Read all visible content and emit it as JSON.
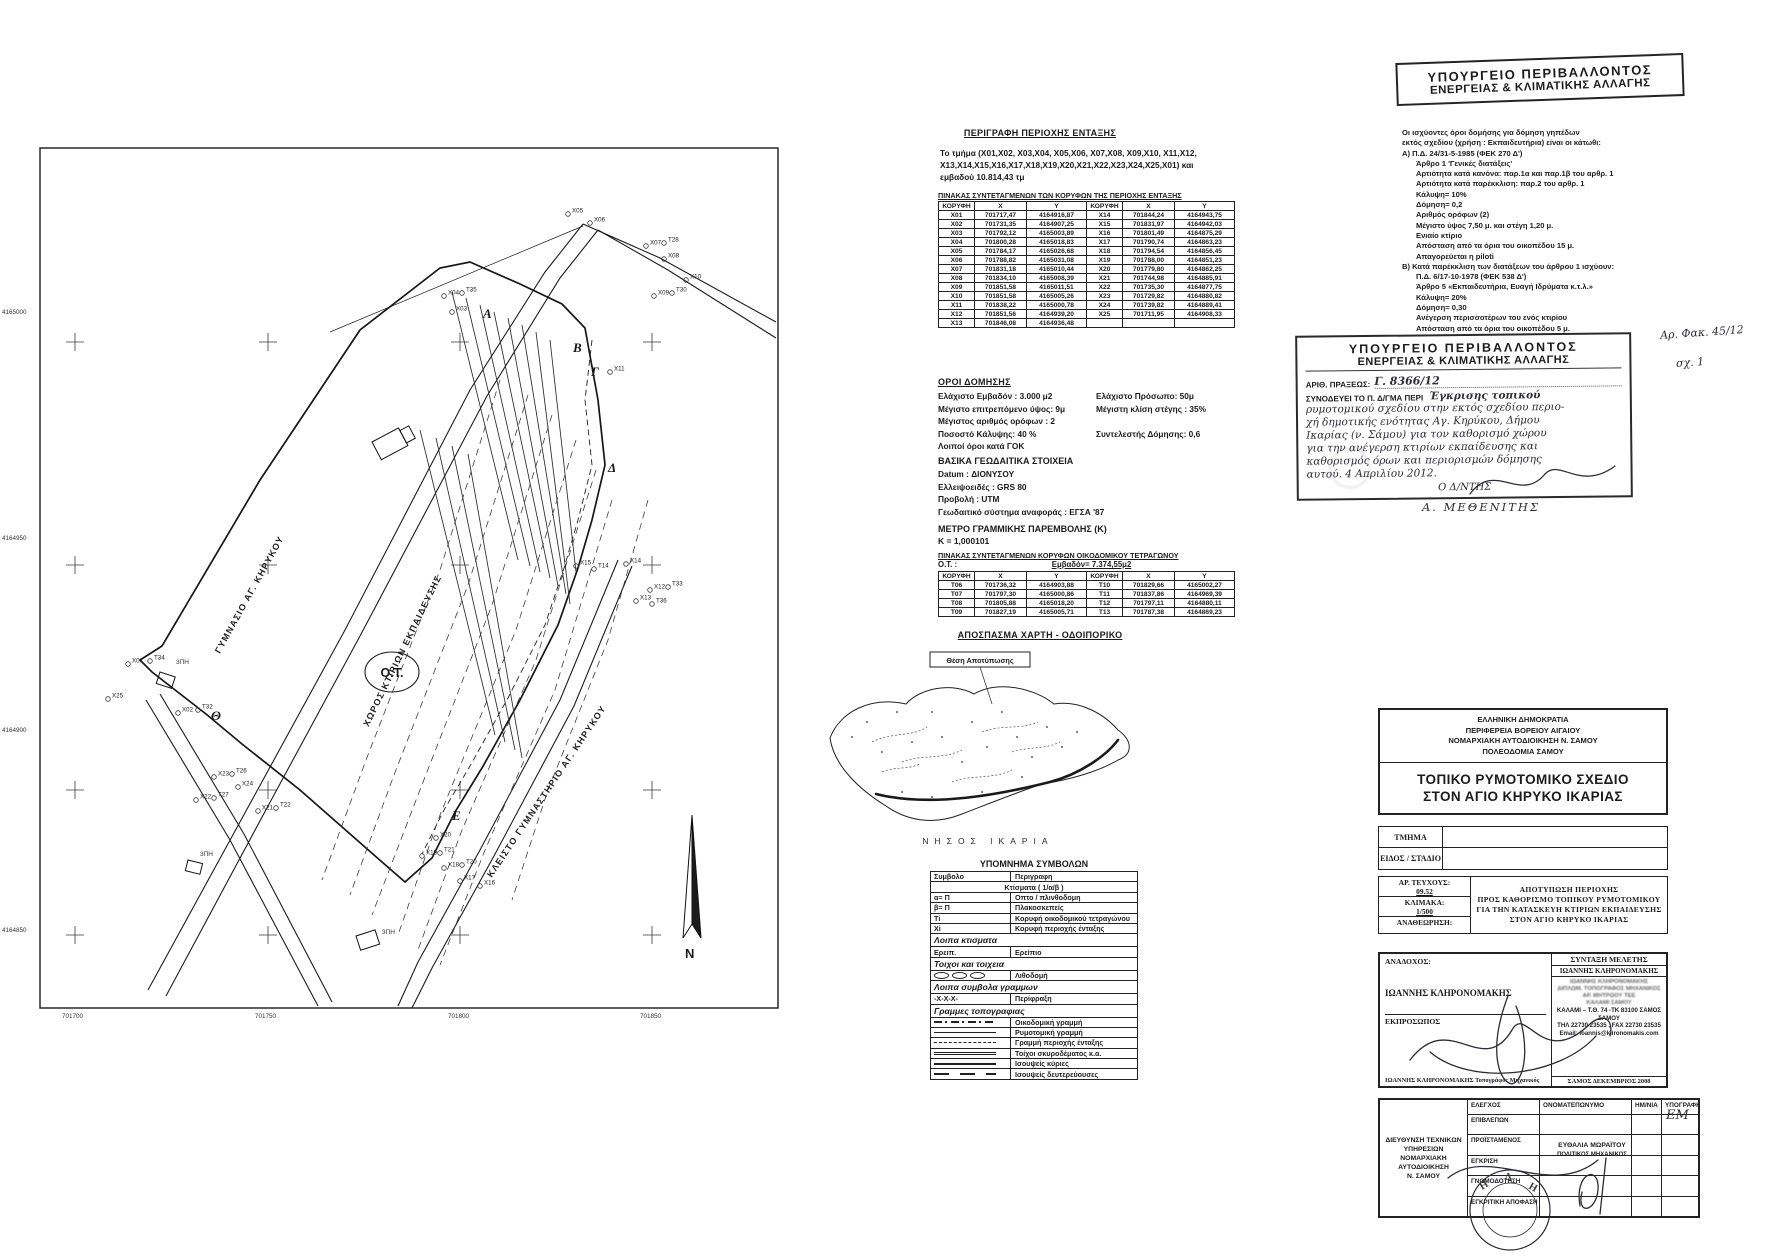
{
  "map": {
    "ot_label": "Ο.Τ.",
    "north_label": "Ν",
    "axis_left": [
      {
        "label": "4165000",
        "x": 2,
        "y": 314
      },
      {
        "label": "4164950",
        "x": 2,
        "y": 540
      },
      {
        "label": "4164900",
        "x": 2,
        "y": 732
      },
      {
        "label": "4164850",
        "x": 2,
        "y": 932
      }
    ],
    "axis_bottom": [
      {
        "label": "701700",
        "x": 62,
        "y": 1018
      },
      {
        "label": "701750",
        "x": 255,
        "y": 1018
      },
      {
        "label": "701800",
        "x": 448,
        "y": 1018
      },
      {
        "label": "701850",
        "x": 640,
        "y": 1018
      }
    ],
    "crosses": [
      {
        "x": 75,
        "y": 342
      },
      {
        "x": 268,
        "y": 342
      },
      {
        "x": 460,
        "y": 342
      },
      {
        "x": 652,
        "y": 342
      },
      {
        "x": 75,
        "y": 565
      },
      {
        "x": 268,
        "y": 565
      },
      {
        "x": 460,
        "y": 565
      },
      {
        "x": 652,
        "y": 565
      },
      {
        "x": 75,
        "y": 790
      },
      {
        "x": 268,
        "y": 790
      },
      {
        "x": 460,
        "y": 790
      },
      {
        "x": 652,
        "y": 790
      },
      {
        "x": 75,
        "y": 935
      },
      {
        "x": 268,
        "y": 935
      },
      {
        "x": 460,
        "y": 935
      },
      {
        "x": 652,
        "y": 935
      }
    ],
    "letters": [
      {
        "label": "Α",
        "x": 483,
        "y": 318
      },
      {
        "label": "Β",
        "x": 573,
        "y": 352
      },
      {
        "label": "Γ",
        "x": 591,
        "y": 376
      },
      {
        "label": "Δ",
        "x": 608,
        "y": 472
      },
      {
        "label": "Ε",
        "x": 452,
        "y": 820
      },
      {
        "label": "Θ",
        "x": 211,
        "y": 720
      }
    ],
    "points": [
      {
        "label": "X01",
        "x": 128,
        "y": 664
      },
      {
        "label": "T34",
        "x": 150,
        "y": 661
      },
      {
        "label": "X25",
        "x": 108,
        "y": 699
      },
      {
        "label": "X02",
        "x": 178,
        "y": 713
      },
      {
        "label": "T32",
        "x": 198,
        "y": 710
      },
      {
        "label": "X23",
        "x": 214,
        "y": 777
      },
      {
        "label": "T26",
        "x": 232,
        "y": 774
      },
      {
        "label": "X22",
        "x": 196,
        "y": 800
      },
      {
        "label": "T27",
        "x": 214,
        "y": 798
      },
      {
        "label": "X24",
        "x": 238,
        "y": 787
      },
      {
        "label": "X21",
        "x": 258,
        "y": 811
      },
      {
        "label": "T22",
        "x": 276,
        "y": 808
      },
      {
        "label": "X03",
        "x": 452,
        "y": 312
      },
      {
        "label": "X04",
        "x": 444,
        "y": 296
      },
      {
        "label": "T35",
        "x": 462,
        "y": 293
      },
      {
        "label": "X05",
        "x": 568,
        "y": 214
      },
      {
        "label": "X06",
        "x": 590,
        "y": 223
      },
      {
        "label": "X07",
        "x": 646,
        "y": 246
      },
      {
        "label": "T28",
        "x": 664,
        "y": 243
      },
      {
        "label": "X08",
        "x": 664,
        "y": 259
      },
      {
        "label": "X09",
        "x": 654,
        "y": 296
      },
      {
        "label": "T30",
        "x": 672,
        "y": 293
      },
      {
        "label": "X10",
        "x": 686,
        "y": 280
      },
      {
        "label": "X11",
        "x": 610,
        "y": 372
      },
      {
        "label": "X12",
        "x": 650,
        "y": 590
      },
      {
        "label": "T33",
        "x": 668,
        "y": 587
      },
      {
        "label": "X13",
        "x": 636,
        "y": 601
      },
      {
        "label": "T36",
        "x": 652,
        "y": 604
      },
      {
        "label": "X14",
        "x": 626,
        "y": 564
      },
      {
        "label": "X15",
        "x": 576,
        "y": 566
      },
      {
        "label": "T14",
        "x": 594,
        "y": 569
      },
      {
        "label": "X20",
        "x": 436,
        "y": 838
      },
      {
        "label": "X19",
        "x": 422,
        "y": 856
      },
      {
        "label": "T21",
        "x": 440,
        "y": 853
      },
      {
        "label": "X18",
        "x": 444,
        "y": 868
      },
      {
        "label": "T20",
        "x": 462,
        "y": 865
      },
      {
        "label": "X17",
        "x": 460,
        "y": 881
      },
      {
        "label": "X16",
        "x": 480,
        "y": 886
      }
    ],
    "small_labels": [
      {
        "label": "3ΠΗ",
        "x": 176,
        "y": 664
      },
      {
        "label": "3ΠΗ",
        "x": 200,
        "y": 856
      },
      {
        "label": "3ΠΗ",
        "x": 382,
        "y": 934
      }
    ],
    "road_labels": [
      {
        "label": "ΓΥΜΝΑΣΙΟ ΑΓ. ΚΗΡΥΚΟΥ",
        "x": 252,
        "y": 596,
        "r": -61
      },
      {
        "label": "ΚΛΕΙΣΤΟ ΓΥΜΝΑΣΤΗΡΙΟ ΑΓ. ΚΗΡΥΚΟΥ",
        "x": 549,
        "y": 793,
        "r": -56
      },
      {
        "label": "ΧΩΡΟΣ ΚΤΙΡΙΩΝ ΕΚΠΑΙΔΕΥΣΗΣ",
        "x": 405,
        "y": 652,
        "r": -64
      }
    ]
  },
  "mid": {
    "perigrafi_title": "ΠΕΡΙΓΡΑΦΗ ΠΕΡΙΟΧΗΣ ΕΝΤΑΞΗΣ",
    "perigrafi_text": "Το τμήμα (Χ01,Χ02, Χ03,Χ04, Χ05,Χ06, Χ07,Χ08, Χ09,Χ10, Χ11,Χ12, Χ13,Χ14,Χ15,Χ16,Χ17,Χ18,Χ19,Χ20,Χ21,Χ22,Χ23,Χ24,Χ25,Χ01) και εμβαδού 10.814,43 τμ",
    "coords_table": {
      "title": "ΠΙΝΑΚΑΣ  ΣΥΝΤΕΤΑΓΜΕΝΩΝ ΤΩΝ  ΚΟΡΥΦΩΝ ΤΗΣ ΠΕΡΙΟΧΗΣ ΕΝΤΑΞΗΣ",
      "headers": [
        "ΚΟΡΥΦΗ",
        "Χ",
        "Υ",
        "ΚΟΡΥΦΗ",
        "Χ",
        "Υ"
      ],
      "rows": [
        [
          "X01",
          "701717,47",
          "4164916,87",
          "X14",
          "701844,24",
          "4164943,75"
        ],
        [
          "X02",
          "701731,35",
          "4164907,25",
          "X15",
          "701831,97",
          "4164942,03"
        ],
        [
          "X03",
          "701792,12",
          "4165003,89",
          "X16",
          "701801,49",
          "4164875,29"
        ],
        [
          "X04",
          "701800,28",
          "4165018,83",
          "X17",
          "701790,74",
          "4164863,23"
        ],
        [
          "X05",
          "701784,17",
          "4165026,68",
          "X18",
          "701794,54",
          "4164856,45"
        ],
        [
          "X06",
          "701788,82",
          "4165031,08",
          "X19",
          "701788,00",
          "4164851,23"
        ],
        [
          "X07",
          "701831,18",
          "4165010,44",
          "X20",
          "701779,80",
          "4164862,25"
        ],
        [
          "X08",
          "701834,10",
          "4165008,39",
          "X21",
          "701744,98",
          "4164885,91"
        ],
        [
          "X09",
          "701851,58",
          "4165011,51",
          "X22",
          "701735,30",
          "4164877,75"
        ],
        [
          "X10",
          "701851,58",
          "4165005,26",
          "X23",
          "701729,82",
          "4164880,82"
        ],
        [
          "X11",
          "701838,22",
          "4165000,78",
          "X24",
          "701739,82",
          "4164889,41"
        ],
        [
          "X12",
          "701851,56",
          "4164939,20",
          "X25",
          "701711,95",
          "4164908,33"
        ],
        [
          "X13",
          "701846,08",
          "4164936,48",
          "",
          "",
          ""
        ]
      ]
    },
    "oroi": {
      "title": "ΟΡΟΙ ΔΟΜΗΣΗΣ",
      "rows": [
        {
          "l": "Ελάχιστο Εμβαδόν : 3.000 μ2",
          "r": "Ελάχιστο Πρόσωπο: 50μ"
        },
        {
          "l": "Μέγιστο επιτρεπόμενο ύψος:  9μ",
          "r": "Μέγιστη κλίση στέγης :  35%"
        },
        {
          "l": "Μέγιστος αριθμός ορόφων : 2",
          "r": ""
        },
        {
          "l": "Ποσοστό Κάλυψης: 40 %",
          "r": "Συντελεστής Δόμησης: 0,6"
        },
        {
          "l": "Λοιποί όροι κατά ΓΟΚ",
          "r": ""
        }
      ]
    },
    "geo": {
      "title": "ΒΑΣΙΚΑ ΓΕΩΔΑΙΤΙΚΑ ΣΤΟΙΧΕΙΑ",
      "lines": [
        "Datum : ΔΙΟΝΥΣΟΥ",
        "Ελλειψοειδές : GRS 80",
        "Προβολή : UTM",
        "Γεωδαιτικό σύστημα αναφοράς : ΕΓΣΑ '87"
      ]
    },
    "metro": {
      "title": "ΜΕΤΡΟ ΓΡΑΜΜΙΚΗΣ ΠΑΡΕΜΒΟΛΗΣ (Κ)",
      "value": "Κ = 1,000101"
    },
    "ot_table": {
      "title": "ΠΙΝΑΚΑΣ  ΣΥΝΤΕΤΑΓΜΕΝΩΝ  ΚΟΡΥΦΩΝ ΟΙΚΟΔΟΜΙΚΟΥ ΤΕΤΡΑΓΩΝΟΥ",
      "ot_label": "Ο.Τ. :",
      "area_label": "Εμβαδόν= 7.374,55μ2",
      "headers": [
        "ΚΟΡΥΦΗ",
        "Χ",
        "Υ",
        "ΚΟΡΥΦΗ",
        "Χ",
        "Υ"
      ],
      "rows": [
        [
          "T06",
          "701736,32",
          "4164903,88",
          "T10",
          "701829,66",
          "4165002,27"
        ],
        [
          "T07",
          "701797,30",
          "4165000,86",
          "T11",
          "701837,86",
          "4164969,39"
        ],
        [
          "T08",
          "701805,88",
          "4165018,20",
          "T12",
          "701797,11",
          "4164880,11"
        ],
        [
          "T09",
          "701827,19",
          "4165005,71",
          "T13",
          "701787,38",
          "4164869,23"
        ]
      ]
    },
    "apospasma_title": "ΑΠΟΣΠΑΣΜΑ ΧΑΡΤΗ - ΟΔΟΙΠΟΡΙΚΟ",
    "island": {
      "box_label": "Θέση Αποτύπωσης",
      "caption": "ΝΗΣΟΣ  ΙΚΑΡΙΑ"
    },
    "legend": {
      "title": "ΥΠΟΜΝΗΜΑ ΣΥΜΒΟΛΩΝ",
      "rows": [
        {
          "kind": "header",
          "sym": "Συμβολο",
          "desc": "Περιγραφη"
        },
        {
          "kind": "span",
          "sym": "",
          "desc": "Κτίσματα    ( 1/α/β )"
        },
        {
          "sym": "α= Π",
          "desc": "Οπτο / πλινθοδομη"
        },
        {
          "sym": "β= Π",
          "desc": "Πλακοσκεπείς"
        },
        {
          "sym": "Τi",
          "desc": "Κορυφή οικοδομικού τετραγώνου"
        },
        {
          "sym": "Xi",
          "desc": "Κορυφή περιοχής ένταξης"
        },
        {
          "kind": "section",
          "sym": "Λοιπα κτισματα",
          "desc": ""
        },
        {
          "sym": "Ερειπ.",
          "desc": "Ερείπιο"
        },
        {
          "kind": "section",
          "sym": "Τοιχοι και τοιχεια",
          "desc": ""
        },
        {
          "cls": "ovals",
          "sym": "",
          "desc": "Λιθοδομή"
        },
        {
          "kind": "section",
          "sym": "Λοιπα συμβολα γραμμων",
          "desc": ""
        },
        {
          "sym": "-Χ-Χ-Χ-",
          "desc": "Περίφραξη"
        },
        {
          "kind": "section",
          "sym": "Γραμμες τοπογραφιας",
          "des c": ""
        },
        {
          "cls": "dashdot",
          "sym": "",
          "desc": "Οικοδομική γραμμή"
        },
        {
          "cls": "solid",
          "sym": "",
          "desc": "Ρυμοτομική γραμμή"
        },
        {
          "cls": "dashed",
          "sym": "",
          "desc": "Γραμμή περιοχής ένταξης"
        },
        {
          "cls": "double",
          "sym": "",
          "desc": "Τοίχοι  σκυροδέματος κ.α."
        },
        {
          "cls": "thick",
          "sym": "",
          "desc": "Ισουψείς κύριες"
        },
        {
          "cls": "longdash",
          "sym": "",
          "desc": "Ισουψείς δευτερεύουσες"
        }
      ]
    }
  },
  "right": {
    "ministry_stamp": {
      "line1": "ΥΠΟΥΡΓΕΙΟ  ΠΕΡΙΒΑΛΛΟΝΤΟΣ",
      "line2": "ΕΝΕΡΓΕΙΑΣ  &  ΚΛΙΜΑΤΙΚΗΣ  ΑΛΛΑΓΗΣ"
    },
    "terms": {
      "lines": [
        {
          "t": "Οι ισχύοντες όροι δομήσης για δόμηση γηπέδων",
          "cls": ""
        },
        {
          "t": "εκτός σχεδίου (χρήση : Εκπαιδευτήρια) είναι οι κάτωθι:",
          "cls": ""
        },
        {
          "t": "Α)  Π.Δ. 24/31-5-1985 (ΦΕΚ 270 Δ')",
          "cls": ""
        },
        {
          "t": "Άρθρο 1   'Γενικές διατάξεις'",
          "cls": "i1"
        },
        {
          "t": "Αρτιότητα κατά κανόνα: παρ.1α και παρ.1β του αρθρ. 1",
          "cls": "i1"
        },
        {
          "t": "Αρτιότητα κατά παρέκκλιση: παρ.2 του αρθρ. 1",
          "cls": "i1"
        },
        {
          "t": "Κάλυψη= 10%",
          "cls": "i1"
        },
        {
          "t": "Δόμηση= 0,2",
          "cls": "i1"
        },
        {
          "t": "Αριθμός ορόφων (2)",
          "cls": "i1"
        },
        {
          "t": "Μέγιστο ύψος 7,50 μ. και στέγη 1,20 μ.",
          "cls": "i1"
        },
        {
          "t": "Ενιαίο κτίριο",
          "cls": "i1"
        },
        {
          "t": "Απόσταση από τα όρια του οικοπέδου 15 μ.",
          "cls": "i1"
        },
        {
          "t": "Απαγορεύεται η piloti",
          "cls": "i1"
        },
        {
          "t": "Β) Κατά παρέκκλιση των διατάξεων του άρθρου 1 ισχύουν:",
          "cls": ""
        },
        {
          "t": "Π.Δ. 6/17-10-1978 (ΦΕΚ 538 Δ')",
          "cls": "i1"
        },
        {
          "t": "Άρθρο 5   «Εκπαιδευτήρια, Ευαγή Ιδρύματα κ.τ.λ.»",
          "cls": "i1"
        },
        {
          "t": "Κάλυψη= 20%",
          "cls": "i1"
        },
        {
          "t": "Δόμηση= 0,30",
          "cls": "i1"
        },
        {
          "t": "Ανέγερση περισσοτέρων του ενός κτιρίου",
          "cls": "i1"
        },
        {
          "t": "Απόσταση από τα όρια του οικοπέδου 5 μ.",
          "cls": "i1"
        }
      ]
    },
    "approval": {
      "line1": "ΥΠΟΥΡΓΕΙΟ  ΠΕΡΙΒΑΛΛΟΝΤΟΣ",
      "line2": "ΕΝΕΡΓΕΙΑΣ  &  ΚΛΙΜΑΤΙΚΗΣ  ΑΛΛΑΓΗΣ",
      "praxis_label": "ΑΡΙΘ. ΠΡΑΞΕΩΣ:",
      "praxis_value": "Γ. 8366/12",
      "accompany_label": "ΣΥΝΟΔΕΥΕΙ ΤΟ Π. Δ/ΓΜΑ ΠΕΡΙ",
      "first_hand": "Έγκρισης τοπικού",
      "hand_lines": [
        "ρυμοτομικού σχεδίου στην εκτός σχεδίου περιο-",
        "χή δημοτικής ενότητας Αγ. Κηρύκου, Δήμου",
        "Ικαρίας (ν. Σάμου) για τον καθορισμό χώρου",
        "για την ανέγερση κτιρίων εκπαίδευσης και",
        "καθορισμός όρων και περιορισμών δόμησης",
        "αυτού.        4 Απριλίου 2012."
      ],
      "director": "Ο  Δ/ΝΤΗΣ",
      "signer": "Α. ΜΕΘΕΝΙΤΗΣ",
      "folder_note": "Αρ. Φακ. 45/12",
      "sheet_note": "σχ. 1"
    },
    "title_block": {
      "org_lines": [
        "ΕΛΛΗΝΙΚΗ ΔΗΜΟΚΡΑΤΙΑ",
        "ΠΕΡΙΦΕΡΕΙΑ ΒΟΡΕΙΟΥ ΑΙΓΑΙΟΥ",
        "ΝΟΜΑΡΧΙΑΚΗ ΑΥΤΟΔΙΟΙΚΗΣΗ  Ν. ΣΑΜΟΥ",
        "ΠΟΛΕΟΔΟΜΙΑ ΣΑΜΟΥ"
      ],
      "title_lines": [
        "ΤΟΠΙΚΟ ΡΥΜΟΤΟΜΙΚΟ ΣΧΕΔΙΟ",
        "ΣΤΟΝ ΑΓΙΟ ΚΗΡΥΚΟ ΙΚΑΡΙΑΣ"
      ],
      "tmima_label": "ΤΜΗΜΑ",
      "eidos_label": "ΕΙΔΟΣ / ΣΤΑΔΙΟ",
      "ar_tefxous_label": "ΑΡ. ΤΕΥΧΟΥΣ:",
      "ar_tefxous_value": "09.52",
      "klimaka_label": "ΚΛΙΜΑΚΑ:",
      "klimaka_value": "1/500",
      "anatheorisi_label": "ΑΝΑΘΕΩΡΗΣΗ:",
      "subject_lines": [
        "ΑΠΟΤΥΠΩΣΗ ΠΕΡΙΟΧΗΣ",
        "ΠΡΟΣ ΚΑΘΟΡΙΣΜΟ ΤΟΠΙΚΟΥ ΡΥΜΟΤΟΜΙΚΟΥ",
        "ΓΙΑ ΤΗΝ ΚΑΤΑΣΚΕΥΗ ΚΤΙΡΙΩΝ ΕΚΠΑΙΔΕΥΣΗΣ",
        "ΣΤΟΝ ΑΓΙΟ ΚΗΡΥΚΟ ΙΚΑΡΙΑΣ"
      ]
    },
    "contractor": {
      "anadoxos_label": "ΑΝΑΔΟΧΟΣ:",
      "anadoxos_name": "ΙΩΑΝΝΗΣ ΚΛΗΡΟΝΟΜΑΚΗΣ",
      "ekprosopos_label": "ΕΚΠΡΟΣΩΠΟΣ",
      "anadoxos_footer": "ΙΩΑΝΝΗΣ ΚΛΗΡΟΝΟΜΑΚΗΣ  Τοπογράφος Μηχανικός",
      "syntaxi_label": "ΣΥΝΤΑΞΗ ΜΕΛΕΤΗΣ",
      "syntaxi_name": "ΙΩΑΝΝΗΣ ΚΛΗΡΟΝΟΜΑΚΗΣ",
      "stamp_lines": [
        "ΙΩΑΝΝΗΣ ΚΛΗΡΟΝΟΜΑΚΗΣ",
        "ΔΙΠΛΩΜ. ΤΟΠΟΓΡΑΦΟΣ ΜΗΧΑΝΙΚΟΣ",
        "ΑΡ. ΜΗΤΡΩΟΥ ΤΕΕ",
        "ΚΑΛΑΜΙ ΣΑΜΟΥ"
      ],
      "address_lines": [
        "ΚΑΛΑΜΙ – Τ.Θ. 74 -ΤΚ 83100 ΣΑΜΟΣ",
        "ΣΑΜΟΥ",
        "ΤΗΛ 22730 23535 , FAX 22730 23535",
        "Email: ioannis@klironomakis.com"
      ],
      "date_line": "ΣΑΜΟΣ ΔΕΚΕΜΒΡΙΟΣ 2008"
    },
    "control": {
      "left_header_lines": [
        "ΔΙΕΥΘΥΝΣΗ ΤΕΧΝΙΚΩΝ",
        "ΥΠΗΡΕΣΙΩΝ",
        "ΝΟΜΑΡΧΙΑΚΗ",
        "ΑΥΤΟΔΙΟΙΚΗΣΗ",
        "Ν. ΣΑΜΟΥ"
      ],
      "col_headers": [
        "ΕΛΕΓΧΟΣ",
        "ΟΝΟΜΑΤΕΠΩΝΥΜΟ",
        "ΗΜ/ΝΙΑ",
        "ΥΠΟΓΡΑΦΗ"
      ],
      "rows": [
        "ΕΠΙΒΛΕΠΩΝ",
        "ΠΡΟΪΣΤΑΜΕΝΟΣ",
        "ΕΓΚΡΙΣΗ",
        "ΓΝΩΜΟΔΟΤΗΣΗ",
        "ΕΓΚΡΙΤΙΚΗ ΑΠΟΦΑΣΗ"
      ],
      "name_value": "ΕΥΘΑΛΙΑ ΜΩΡΑΪΤΟΥ",
      "name_title": "ΠΟΛΙΤΙΚΟΣ ΜΗΧΑΝΙΚΟΣ",
      "signature_initials": "ΕΜ"
    }
  }
}
